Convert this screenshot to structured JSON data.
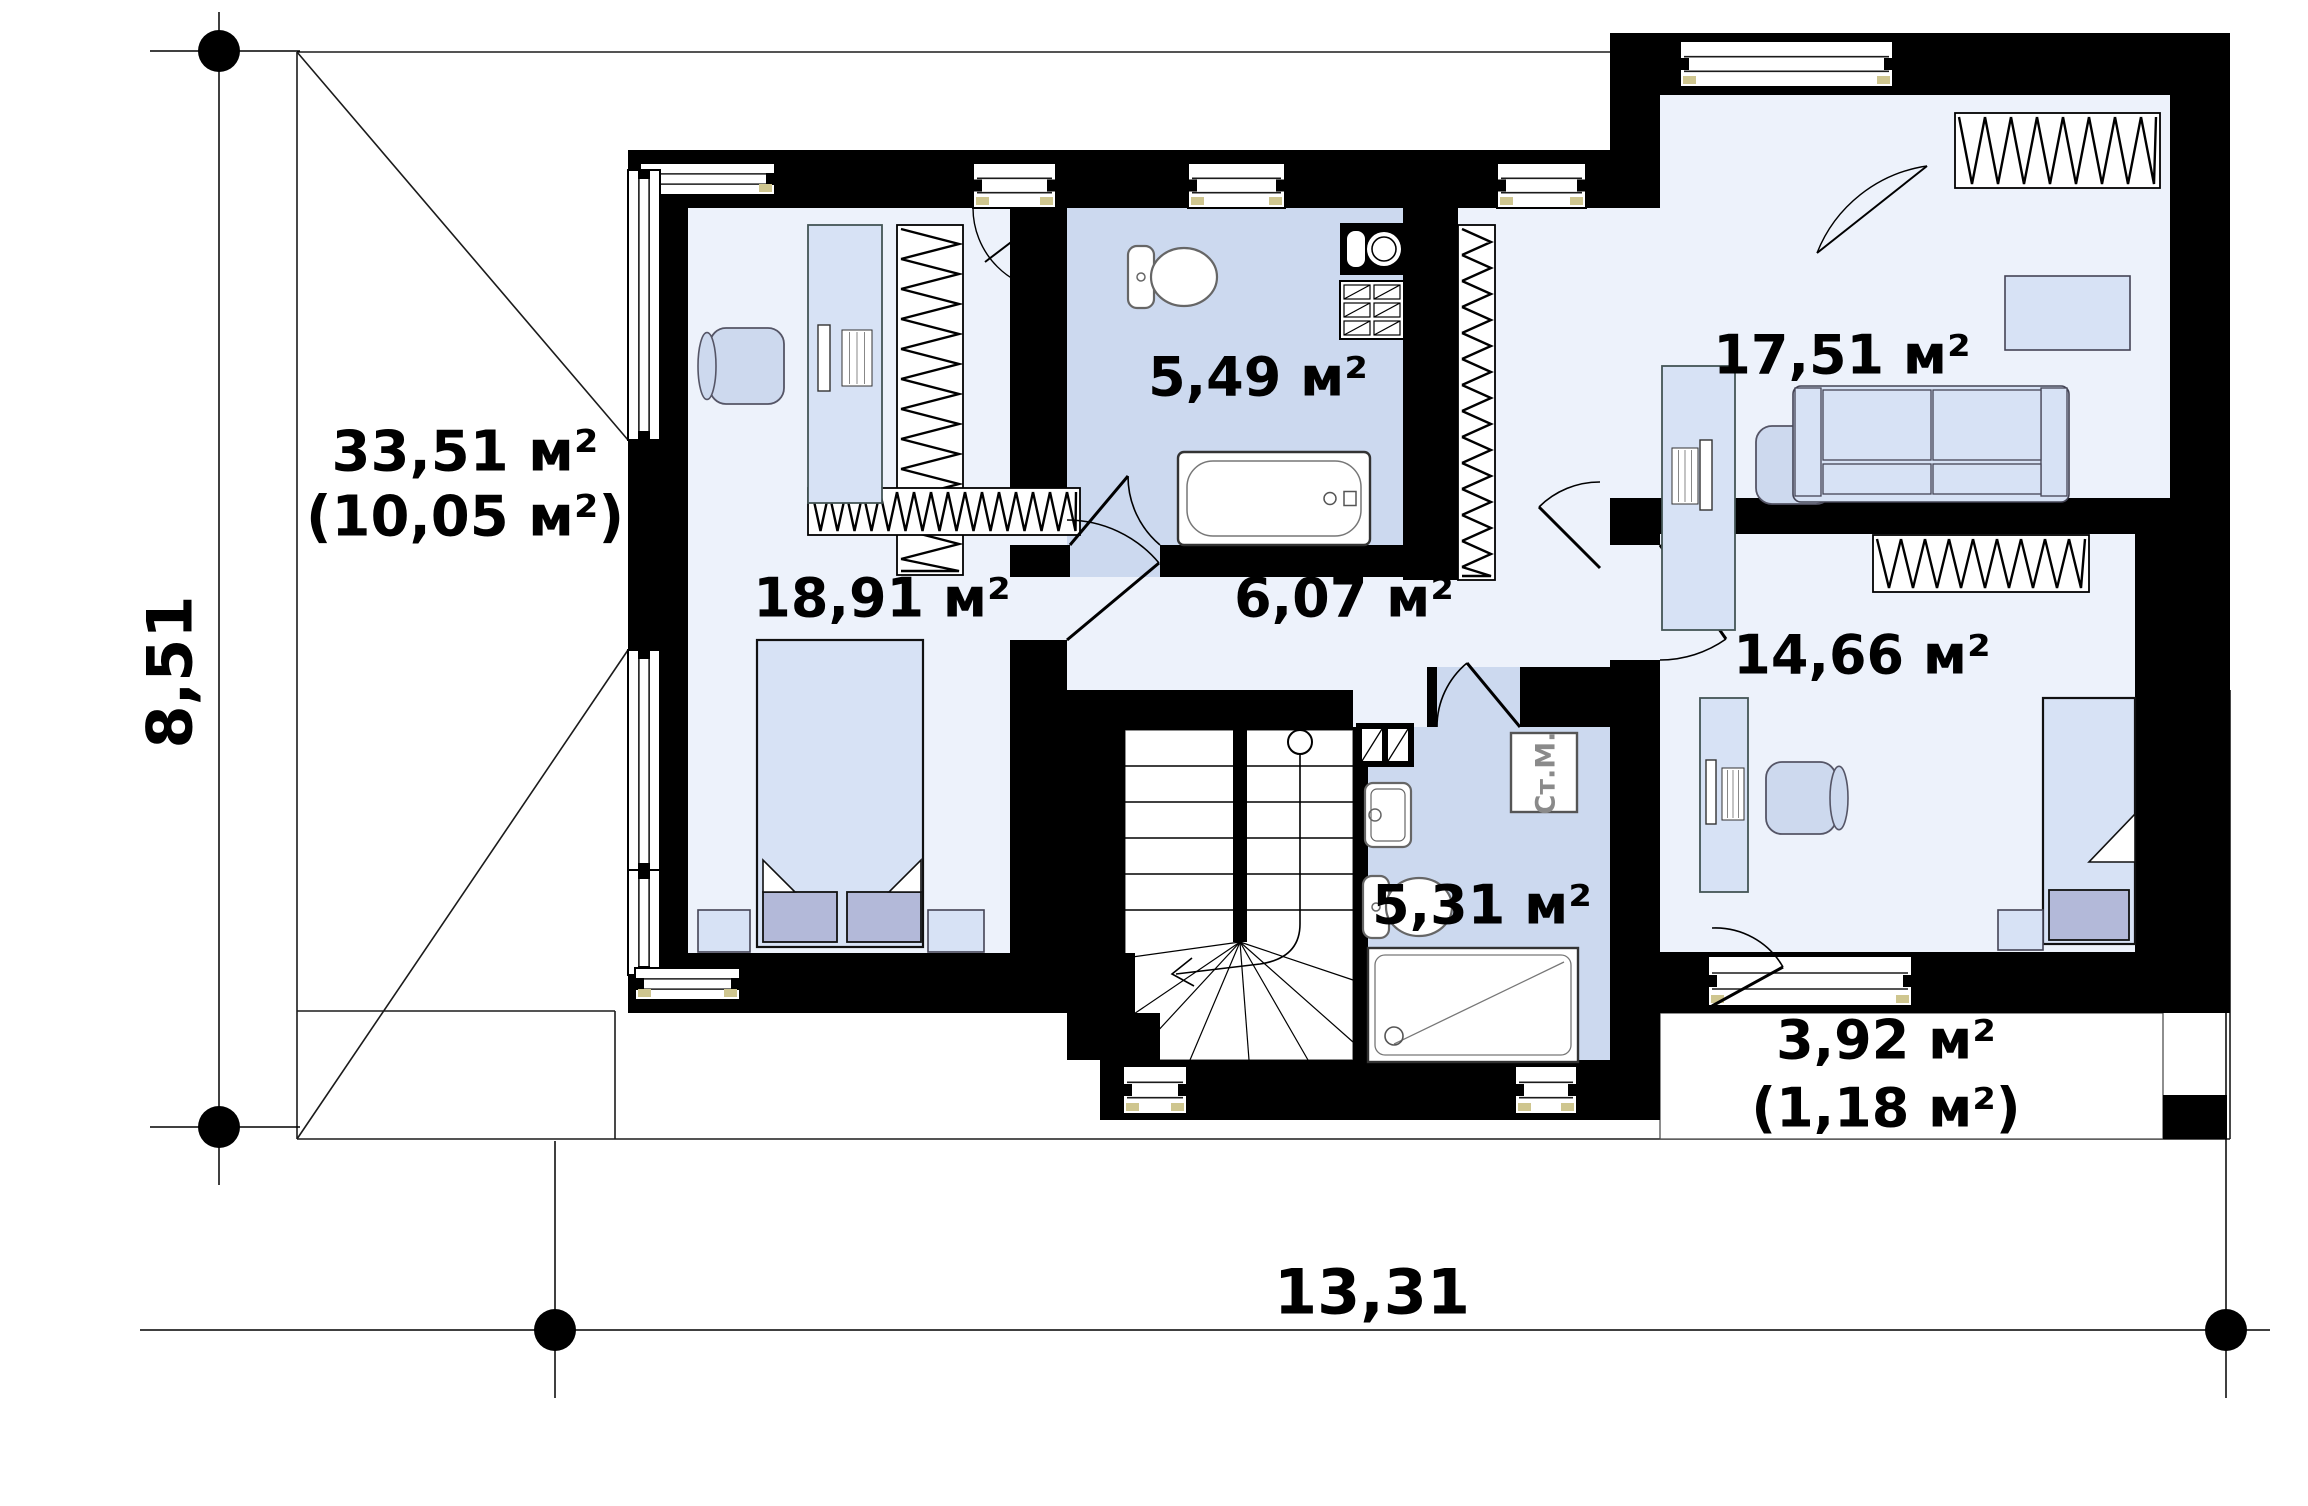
{
  "plan": {
    "canvas": {
      "w": 2308,
      "h": 1506,
      "bg": "#ffffff"
    },
    "colors": {
      "wall": "#000000",
      "room": "#edf2fb",
      "bath": "#ccd9ef",
      "furniture": "#d7e2f5",
      "furniture_dark": "#b3b9d9",
      "thin_line": "#1b1b1b",
      "fixture_stroke": "#666666",
      "washer_text": "#8a8a8a",
      "sill": "#cfc68f"
    },
    "area_labels": [
      {
        "id": "roof-left-area",
        "text": "33,51 м²",
        "x": 465,
        "y": 452,
        "size": 56
      },
      {
        "id": "roof-left-area2",
        "text": "(10,05 м²)",
        "x": 465,
        "y": 517,
        "size": 56
      },
      {
        "id": "bedroom-area",
        "text": "18,91 м²",
        "x": 882,
        "y": 598,
        "size": 54
      },
      {
        "id": "bath-top-area",
        "text": "5,49 м²",
        "x": 1258,
        "y": 377,
        "size": 54
      },
      {
        "id": "hall-area",
        "text": "6,07 м²",
        "x": 1344,
        "y": 598,
        "size": 54
      },
      {
        "id": "office-area",
        "text": "17,51 м²",
        "x": 1842,
        "y": 355,
        "size": 54
      },
      {
        "id": "room-right-area",
        "text": "14,66 м²",
        "x": 1862,
        "y": 655,
        "size": 54
      },
      {
        "id": "bath-bottom-area",
        "text": "5,31 м²",
        "x": 1482,
        "y": 905,
        "size": 54
      },
      {
        "id": "terrace-area",
        "text": "3,92 м²",
        "x": 1886,
        "y": 1040,
        "size": 54
      },
      {
        "id": "terrace-area2",
        "text": "(1,18 м²)",
        "x": 1886,
        "y": 1108,
        "size": 54
      },
      {
        "id": "washer-label",
        "text": "Ст.М.",
        "x": 1546,
        "y": 773,
        "size": 27,
        "rotate": -90,
        "color": "#8a8a8a"
      }
    ],
    "dimensions": {
      "left": {
        "text": "8,51",
        "x": 170,
        "y": 672,
        "size": 62,
        "rotate": -90
      },
      "bottom": {
        "text": "13,31",
        "x": 1372,
        "y": 1292,
        "size": 62
      },
      "lines": [
        [
          219,
          12,
          219,
          1185
        ],
        [
          150,
          51,
          300,
          51
        ],
        [
          150,
          1127,
          300,
          1127
        ],
        [
          140,
          1330,
          2270,
          1330
        ],
        [
          555,
          1141,
          555,
          1398
        ],
        [
          2226,
          700,
          2226,
          1398
        ]
      ],
      "dots": [
        [
          219,
          51
        ],
        [
          219,
          1127
        ],
        [
          555,
          1330
        ],
        [
          2226,
          1330
        ]
      ],
      "dot_radius": 21
    },
    "roof_lines": [
      [
        297,
        52,
        1613,
        52
      ],
      [
        297,
        52,
        297,
        1139
      ],
      [
        297,
        1139,
        2230,
        1139
      ],
      [
        2230,
        690,
        2230,
        1139
      ],
      [
        297,
        52,
        628,
        440
      ],
      [
        297,
        1139,
        628,
        650
      ],
      [
        615,
        1011,
        615,
        1139
      ],
      [
        297,
        1011,
        615,
        1011
      ],
      [
        1613,
        52,
        1660,
        99
      ]
    ],
    "floors": [
      {
        "id": "bedroom-floor",
        "x": 688,
        "y": 208,
        "w": 322,
        "h": 745,
        "c": "room"
      },
      {
        "id": "bedroom-door-gap",
        "x": 1010,
        "y": 520,
        "w": 57,
        "h": 120,
        "c": "room"
      },
      {
        "id": "bath-top-floor",
        "x": 1067,
        "y": 208,
        "w": 336,
        "h": 369,
        "c": "bath"
      },
      {
        "id": "bath-top-door-gap",
        "x": 1070,
        "y": 545,
        "w": 90,
        "h": 32,
        "c": "bath"
      },
      {
        "id": "corridor-strip-floor",
        "x": 1458,
        "y": 208,
        "w": 152,
        "h": 407,
        "c": "room"
      },
      {
        "id": "office-nook-floor",
        "x": 1610,
        "y": 208,
        "w": 50,
        "h": 290,
        "c": "room"
      },
      {
        "id": "hall-floor",
        "x": 1067,
        "y": 577,
        "w": 543,
        "h": 113,
        "c": "room"
      },
      {
        "id": "stair-landing-floor",
        "x": 1353,
        "y": 690,
        "w": 74,
        "h": 37,
        "c": "room"
      },
      {
        "id": "room1466-door-gap",
        "x": 1610,
        "y": 545,
        "w": 50,
        "h": 115,
        "c": "room"
      },
      {
        "id": "office-floor",
        "x": 1660,
        "y": 95,
        "w": 510,
        "h": 403,
        "c": "room"
      },
      {
        "id": "room1466-floor",
        "x": 1660,
        "y": 534,
        "w": 475,
        "h": 418,
        "c": "room"
      },
      {
        "id": "bath-bottom-floor",
        "x": 1368,
        "y": 727,
        "w": 242,
        "h": 333,
        "c": "bath"
      },
      {
        "id": "bath-bottom-door-gap",
        "x": 1437,
        "y": 667,
        "w": 83,
        "h": 60,
        "c": "bath"
      },
      {
        "id": "stair-floor",
        "x": 1125,
        "y": 730,
        "w": 228,
        "h": 330,
        "c": "white"
      },
      {
        "id": "terrace-floor",
        "x": 1660,
        "y": 1013,
        "w": 503,
        "h": 126,
        "c": "white"
      }
    ],
    "walls": [
      [
        628,
        150,
        1032,
        58
      ],
      [
        1610,
        33,
        620,
        62
      ],
      [
        1610,
        33,
        50,
        175
      ],
      [
        628,
        150,
        60,
        863
      ],
      [
        628,
        953,
        507,
        60
      ],
      [
        1100,
        1013,
        60,
        47
      ],
      [
        1100,
        1060,
        510,
        60
      ],
      [
        1610,
        952,
        50,
        168
      ],
      [
        1660,
        952,
        570,
        61
      ],
      [
        2170,
        33,
        60,
        501
      ],
      [
        2135,
        534,
        95,
        418
      ],
      [
        2163,
        1095,
        64,
        44
      ],
      [
        1660,
        498,
        510,
        36
      ],
      [
        1610,
        498,
        50,
        47
      ],
      [
        1610,
        660,
        50,
        292
      ],
      [
        1010,
        150,
        57,
        370
      ],
      [
        1010,
        640,
        57,
        373
      ],
      [
        1010,
        545,
        60,
        32
      ],
      [
        1160,
        545,
        243,
        32
      ],
      [
        1403,
        150,
        55,
        430
      ],
      [
        1067,
        690,
        286,
        40
      ],
      [
        1427,
        667,
        10,
        60
      ],
      [
        1520,
        667,
        90,
        60
      ],
      [
        1067,
        730,
        58,
        330
      ],
      [
        1353,
        727,
        15,
        333
      ]
    ],
    "windows": [
      {
        "id": "win-corner-top",
        "x": 640,
        "y": 163,
        "w": 135,
        "h": 32,
        "o": "h"
      },
      {
        "id": "win-left-upper",
        "x": 628,
        "y": 170,
        "w": 32,
        "h": 270,
        "o": "v"
      },
      {
        "id": "win-top-bedroom",
        "x": 973,
        "y": 163,
        "w": 83,
        "h": 45,
        "o": "h"
      },
      {
        "id": "win-top-bath",
        "x": 1188,
        "y": 163,
        "w": 97,
        "h": 45,
        "o": "h"
      },
      {
        "id": "win-top-strip",
        "x": 1497,
        "y": 163,
        "w": 89,
        "h": 45,
        "o": "h"
      },
      {
        "id": "win-top-office",
        "x": 1680,
        "y": 41,
        "w": 213,
        "h": 46,
        "o": "h"
      },
      {
        "id": "win-left-lower",
        "x": 628,
        "y": 650,
        "w": 32,
        "h": 222,
        "o": "v"
      },
      {
        "id": "win-corner-bottom-v",
        "x": 628,
        "y": 870,
        "w": 32,
        "h": 105,
        "o": "v"
      },
      {
        "id": "win-corner-bottom-h",
        "x": 635,
        "y": 968,
        "w": 105,
        "h": 32,
        "o": "h"
      },
      {
        "id": "win-bottom-stair",
        "x": 1123,
        "y": 1066,
        "w": 64,
        "h": 48,
        "o": "h"
      },
      {
        "id": "win-bottom-bath",
        "x": 1515,
        "y": 1066,
        "w": 62,
        "h": 48,
        "o": "h"
      },
      {
        "id": "win-terrace-door",
        "x": 1708,
        "y": 956,
        "w": 204,
        "h": 50,
        "o": "h"
      }
    ],
    "wardrobes": [
      {
        "id": "wardrobe-bedroom",
        "x": 897,
        "y": 225,
        "w": 66,
        "h": 350,
        "step": 30
      },
      {
        "id": "dresser-bedroom",
        "x": 808,
        "y": 488,
        "w": 272,
        "h": 47,
        "step": 17
      },
      {
        "id": "wardrobe-corridor",
        "x": 1458,
        "y": 225,
        "w": 37,
        "h": 355,
        "step": 26
      },
      {
        "id": "wardrobe-office",
        "x": 1955,
        "y": 113,
        "w": 205,
        "h": 75,
        "step": 26
      },
      {
        "id": "wardrobe-room1466",
        "x": 1873,
        "y": 535,
        "w": 216,
        "h": 57,
        "step": 24
      }
    ],
    "doors": [
      {
        "id": "door-bedroom",
        "leaf": [
          1067,
          640,
          1159,
          563
        ],
        "arc": "M 1067,520 A 120 120 0 0 1 1159,563"
      },
      {
        "id": "door-bath-top",
        "leaf": [
          1070,
          545,
          1128,
          476
        ],
        "arc": "M 1160,545 A 90 90 0 0 1 1128,476"
      },
      {
        "id": "door-office",
        "leaf": [
          1600,
          568,
          1539,
          507
        ],
        "arc": "M 1600,482 A 86 86 0 0 0 1539,507"
      },
      {
        "id": "door-bath-bottom",
        "leaf": [
          1520,
          727,
          1467,
          663
        ],
        "arc": "M 1437,727 A 83 83 0 0 1 1467,663"
      },
      {
        "id": "door-room1466",
        "leaf": [
          1660,
          545,
          1726,
          639
        ],
        "arc": "M 1660,660 A 115 115 0 0 0 1726,639"
      },
      {
        "id": "door-terrace",
        "leaf": [
          1712,
          1006,
          1783,
          967
        ],
        "arc": "M 1712,928 A 78 78 0 0 1 1783,967"
      }
    ],
    "casements": [
      {
        "id": "casement-bedroom",
        "leaf": [
          1056,
          208,
          985,
          262
        ],
        "arc": "M 973,208 A 83 83 0 0 0 1056,291"
      },
      {
        "id": "casement-office",
        "leaf": [
          1927,
          166,
          1817,
          253
        ],
        "arc": "M 1817,253 A 140 140 0 0 1 1927,166"
      }
    ],
    "furniture": [
      {
        "type": "desk",
        "id": "desk-bedroom",
        "x": 808,
        "y": 225,
        "w": 74,
        "h": 278,
        "mon": [
          818,
          325,
          12,
          66
        ],
        "kb": [
          842,
          330,
          30,
          56
        ]
      },
      {
        "type": "chair",
        "id": "chair-bedroom",
        "x": 710,
        "y": 328,
        "w": 74,
        "h": 76,
        "back": "left"
      },
      {
        "type": "bed",
        "id": "bed-bedroom",
        "x": 757,
        "y": 640,
        "w": 166,
        "h": 307,
        "pillows": [
          [
            763,
            892,
            74,
            50
          ],
          [
            847,
            892,
            74,
            50
          ]
        ],
        "folds": [
          "M 763,892 L 795,892 L 763,860 Z",
          "M 921,892 L 889,892 L 921,860 Z"
        ]
      },
      {
        "type": "box",
        "id": "nightstand-left",
        "x": 698,
        "y": 910,
        "w": 52,
        "h": 42
      },
      {
        "type": "box",
        "id": "nightstand-right",
        "x": 928,
        "y": 910,
        "w": 56,
        "h": 42
      },
      {
        "type": "toilet",
        "id": "toilet-top",
        "x": 1128,
        "y": 246
      },
      {
        "type": "counter",
        "id": "vanity-top",
        "x": 1340,
        "y": 223,
        "w": 64,
        "h": 52
      },
      {
        "type": "cabx",
        "id": "cabinet-top",
        "x": 1340,
        "y": 281,
        "w": 64,
        "h": 58
      },
      {
        "type": "tub",
        "id": "bathtub",
        "x": 1178,
        "y": 452,
        "w": 192,
        "h": 93
      },
      {
        "type": "desk",
        "id": "desk-office",
        "x": 1662,
        "y": 366,
        "w": 73,
        "h": 264,
        "mon": [
          1700,
          440,
          12,
          70
        ],
        "kb": [
          1672,
          448,
          26,
          56
        ]
      },
      {
        "type": "chair",
        "id": "chair-office",
        "x": 1756,
        "y": 426,
        "w": 76,
        "h": 78,
        "back": "right"
      },
      {
        "type": "box",
        "id": "table-office",
        "x": 2005,
        "y": 276,
        "w": 125,
        "h": 74
      },
      {
        "type": "sofa",
        "id": "sofa-office",
        "x": 1793,
        "y": 386,
        "w": 276,
        "h": 116
      },
      {
        "type": "desk",
        "id": "desk-room1466",
        "x": 1700,
        "y": 698,
        "w": 48,
        "h": 194,
        "mon": [
          1706,
          760,
          10,
          64
        ],
        "kb": [
          1722,
          768,
          22,
          52
        ]
      },
      {
        "type": "chair",
        "id": "chair-room1466",
        "x": 1766,
        "y": 762,
        "w": 70,
        "h": 72,
        "back": "right"
      },
      {
        "type": "bed",
        "id": "bed-room1466",
        "x": 2043,
        "y": 698,
        "w": 92,
        "h": 246,
        "pillows": [
          [
            2049,
            890,
            80,
            50
          ]
        ],
        "folds": [
          "M 2135,814 L 2135,862 L 2089,862 Z"
        ]
      },
      {
        "type": "box",
        "id": "bench-room1466",
        "x": 1998,
        "y": 910,
        "w": 45,
        "h": 40
      },
      {
        "type": "glassblock",
        "id": "glassblock-bath",
        "x": 1356,
        "y": 723,
        "w": 58,
        "h": 44
      },
      {
        "type": "sink",
        "id": "sink-bath",
        "x": 1365,
        "y": 783,
        "w": 46,
        "h": 64
      },
      {
        "type": "washer",
        "id": "washing-machine",
        "x": 1511,
        "y": 733,
        "w": 66,
        "h": 79
      },
      {
        "type": "toilet",
        "id": "toilet-bottom",
        "x": 1363,
        "y": 876
      },
      {
        "type": "shower",
        "id": "shower-tray",
        "x": 1368,
        "y": 948,
        "w": 210,
        "h": 114
      }
    ],
    "stairs": {
      "x": 1125,
      "y": 730,
      "w": 228,
      "h": 330,
      "divider": [
        1233,
        730,
        14,
        212
      ],
      "tread_ys": [
        766,
        802,
        838,
        874,
        910
      ],
      "left_x": [
        1125,
        1233
      ],
      "right_x": [
        1247,
        1353
      ],
      "fan_center": [
        1240,
        942
      ],
      "fan_targets": [
        [
          1125,
          958
        ],
        [
          1125,
          1020
        ],
        [
          1131,
          1060
        ],
        [
          1190,
          1060
        ],
        [
          1249,
          1060
        ],
        [
          1308,
          1060
        ],
        [
          1353,
          1042
        ],
        [
          1353,
          980
        ]
      ],
      "dir_circle": [
        1300,
        742,
        12
      ],
      "dir_path": "M 1300,754 L 1300,924 Q 1300,958 1260,964 L 1176,974",
      "dir_arrow": "M 1192,958 L 1172,974 L 1194,986"
    }
  }
}
